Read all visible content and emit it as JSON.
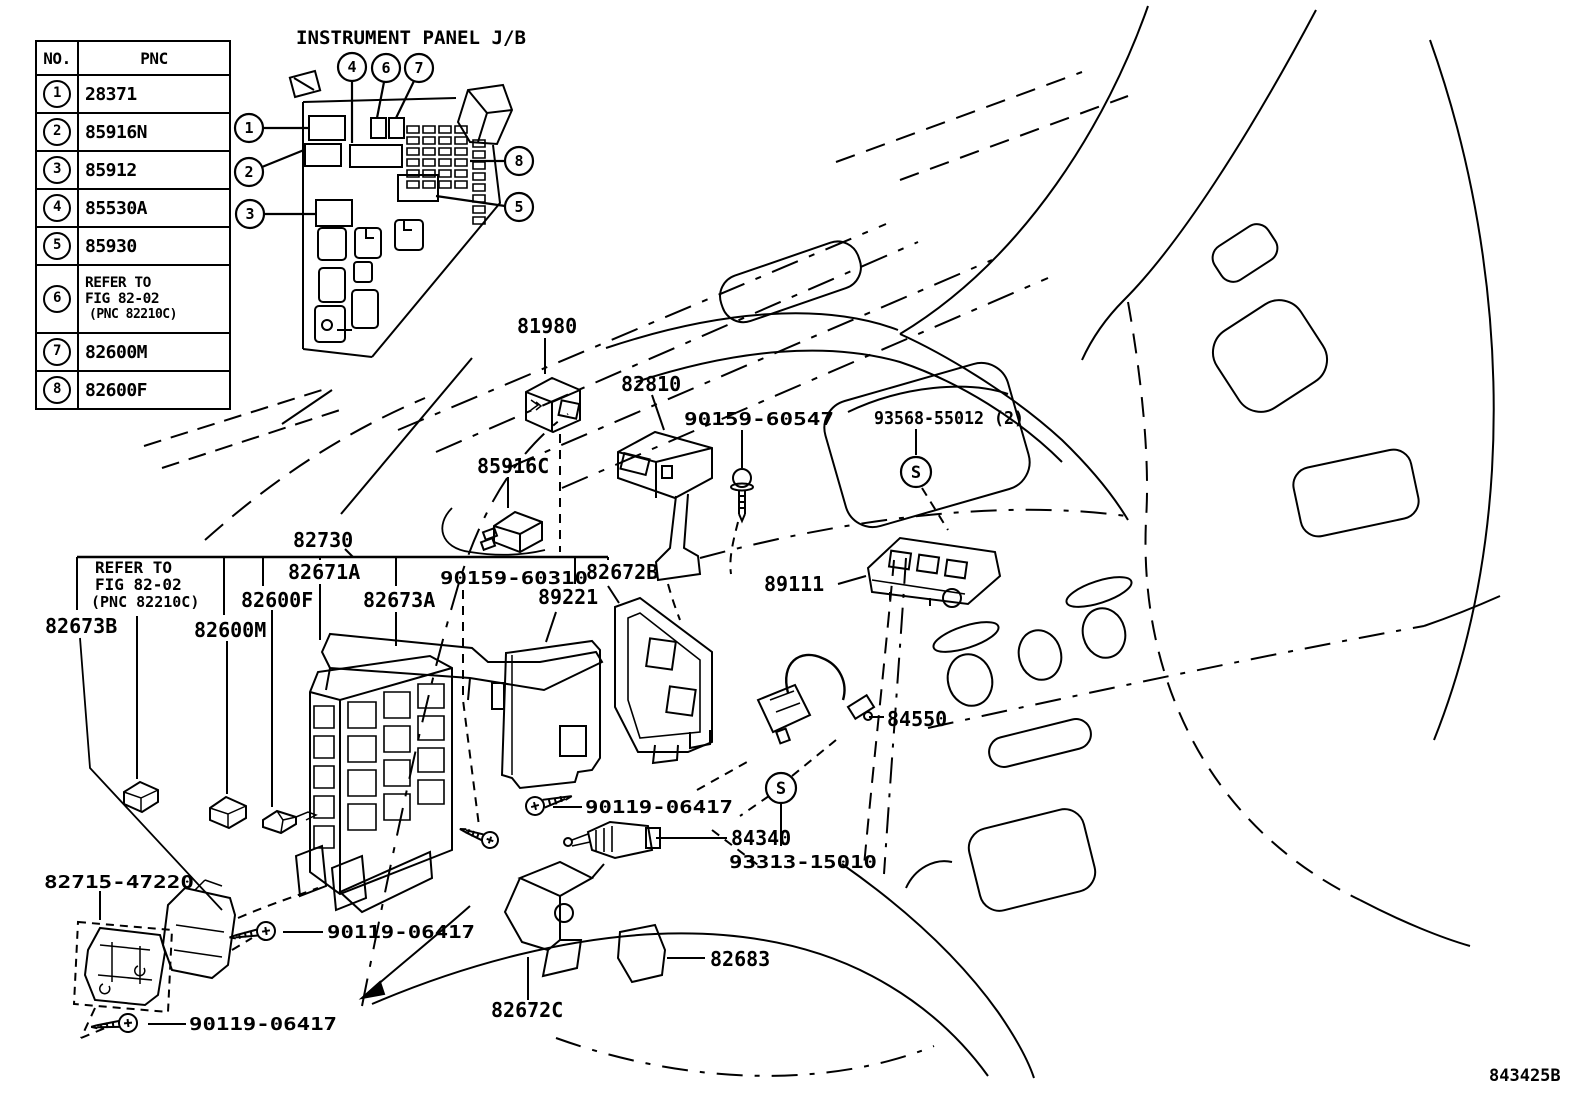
{
  "meta": {
    "inset_title": "INSTRUMENT PANEL J/B",
    "drawing_number": "843425B"
  },
  "colors": {
    "ink": "#000000",
    "paper": "#ffffff"
  },
  "table": {
    "headers": {
      "no": "NO.",
      "pnc": "PNC"
    },
    "rows": [
      {
        "no": "1",
        "pnc": "28371"
      },
      {
        "no": "2",
        "pnc": "85916N"
      },
      {
        "no": "3",
        "pnc": "85912"
      },
      {
        "no": "4",
        "pnc": "85530A"
      },
      {
        "no": "5",
        "pnc": "85930"
      },
      {
        "no": "6",
        "pnc_lines": [
          "REFER TO",
          "FIG 82-02",
          "(PNC 82210C)"
        ]
      },
      {
        "no": "7",
        "pnc": "82600M"
      },
      {
        "no": "8",
        "pnc": "82600F"
      }
    ]
  },
  "callouts": {
    "c1": "1",
    "c2": "2",
    "c3": "3",
    "c4": "4",
    "c5": "5",
    "c6": "6",
    "c7": "7",
    "c8": "8"
  },
  "refer_note": {
    "lines": [
      "REFER TO",
      "FIG 82-02",
      "(PNC 82210C)"
    ]
  },
  "labels": {
    "l81980": "81980",
    "l82810": "82810",
    "l90159_60547": "90159-60547",
    "l93568_55012": "93568-55012 (2)",
    "l85916C": "85916C",
    "l82730": "82730",
    "l82671A": "82671A",
    "l82600F": "82600F",
    "l82673A": "82673A",
    "l90159_60310": "90159-60310",
    "l82672B": "82672B",
    "l89221": "89221",
    "l89111": "89111",
    "l82600M": "82600M",
    "l82673B": "82673B",
    "l84550": "84550",
    "l90119_06417_a": "90119-06417",
    "l84340": "84340",
    "l93313_15010": "93313-15010",
    "l82715_47220": "82715-47220",
    "l90119_06417_b": "90119-06417",
    "l82683": "82683",
    "l82672C": "82672C",
    "l90119_06417_c": "90119-06417",
    "s_symbol": "S"
  }
}
